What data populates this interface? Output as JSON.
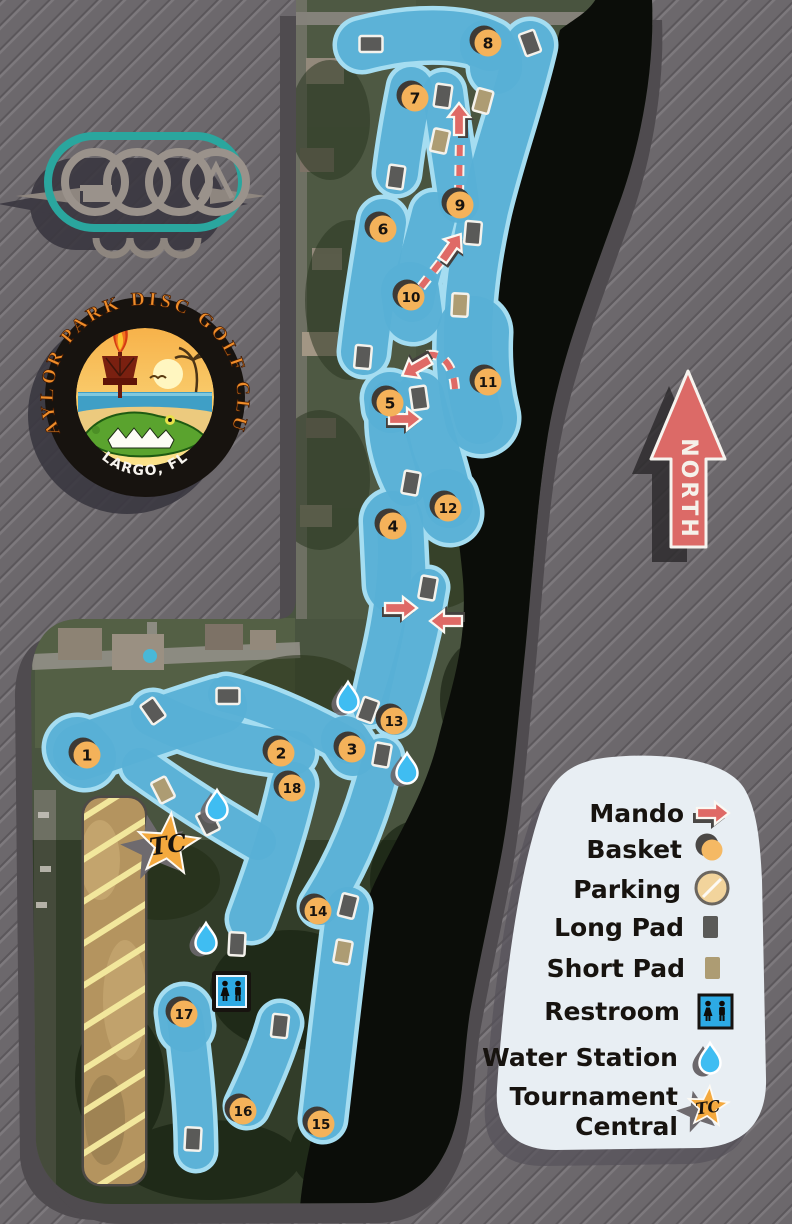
{
  "title": "Taylor Park Disc Golf Club Course Map",
  "colors": {
    "background": "#6c686c",
    "fairway": "#58b0d5",
    "fairway_border": "#a5ddf1",
    "mando_red": "#df6a66",
    "basket_orange": "#f4b25a",
    "parking_tan": "#f2d49c",
    "long_pad": "#5a5a58",
    "short_pad": "#ad9c73",
    "water_blue": "#3fbdf2",
    "legend_bg": "#e8eef3",
    "logo_teal": "#2aa69e",
    "lake": "#0b0d09"
  },
  "north_label": "NORTH",
  "club_logo": {
    "arc_text": "TAYLOR PARK DISC GOLF CLUB",
    "bottom_text": "LARGO, FL"
  },
  "legend": {
    "items": [
      {
        "label": "Mando",
        "icon": "mando-arrow"
      },
      {
        "label": "Basket",
        "icon": "basket-circle"
      },
      {
        "label": "Parking",
        "icon": "parking-circle"
      },
      {
        "label": "Long Pad",
        "icon": "long-pad-rect"
      },
      {
        "label": "Short Pad",
        "icon": "short-pad-rect"
      },
      {
        "label": "Restroom",
        "icon": "restroom-sign"
      },
      {
        "label": "Water Station",
        "icon": "water-drop"
      },
      {
        "line1": "Tournament",
        "line2": "Central",
        "icon": "tc-star"
      }
    ],
    "tc_icon_label": "TC"
  },
  "map": {
    "holes": [
      {
        "n": 1,
        "x": 87,
        "y": 755
      },
      {
        "n": 2,
        "x": 281,
        "y": 753
      },
      {
        "n": 3,
        "x": 352,
        "y": 749
      },
      {
        "n": 4,
        "x": 393,
        "y": 526
      },
      {
        "n": 5,
        "x": 390,
        "y": 403
      },
      {
        "n": 6,
        "x": 383,
        "y": 229
      },
      {
        "n": 7,
        "x": 415,
        "y": 98
      },
      {
        "n": 8,
        "x": 488,
        "y": 43
      },
      {
        "n": 9,
        "x": 460,
        "y": 205
      },
      {
        "n": 10,
        "x": 411,
        "y": 297
      },
      {
        "n": 11,
        "x": 488,
        "y": 382
      },
      {
        "n": 12,
        "x": 448,
        "y": 508
      },
      {
        "n": 13,
        "x": 394,
        "y": 721
      },
      {
        "n": 14,
        "x": 318,
        "y": 911
      },
      {
        "n": 15,
        "x": 321,
        "y": 1124
      },
      {
        "n": 16,
        "x": 243,
        "y": 1111
      },
      {
        "n": 17,
        "x": 184,
        "y": 1014
      },
      {
        "n": 18,
        "x": 292,
        "y": 788
      }
    ],
    "tee_pads": [
      {
        "type": "long",
        "x": 371,
        "y": 44,
        "rot": 90
      },
      {
        "type": "long",
        "x": 530,
        "y": 43,
        "rot": -20
      },
      {
        "type": "long",
        "x": 443,
        "y": 96,
        "rot": 8
      },
      {
        "type": "short",
        "x": 483,
        "y": 101,
        "rot": 15
      },
      {
        "type": "short",
        "x": 440,
        "y": 141,
        "rot": 12
      },
      {
        "type": "long",
        "x": 396,
        "y": 177,
        "rot": 8
      },
      {
        "type": "long",
        "x": 473,
        "y": 233,
        "rot": 5
      },
      {
        "type": "short",
        "x": 460,
        "y": 305,
        "rot": 3
      },
      {
        "type": "long",
        "x": 363,
        "y": 357,
        "rot": 5
      },
      {
        "type": "long",
        "x": 419,
        "y": 398,
        "rot": -8
      },
      {
        "type": "long",
        "x": 411,
        "y": 483,
        "rot": 10
      },
      {
        "type": "long",
        "x": 428,
        "y": 588,
        "rot": 10
      },
      {
        "type": "long",
        "x": 368,
        "y": 710,
        "rot": 20
      },
      {
        "type": "long",
        "x": 382,
        "y": 755,
        "rot": 10
      },
      {
        "type": "long",
        "x": 153,
        "y": 711,
        "rot": -35
      },
      {
        "type": "long",
        "x": 228,
        "y": 696,
        "rot": 90
      },
      {
        "type": "short",
        "x": 163,
        "y": 790,
        "rot": -27
      },
      {
        "type": "long",
        "x": 208,
        "y": 822,
        "rot": -27
      },
      {
        "type": "long",
        "x": 348,
        "y": 906,
        "rot": 14
      },
      {
        "type": "short",
        "x": 343,
        "y": 952,
        "rot": 10
      },
      {
        "type": "long",
        "x": 237,
        "y": 944,
        "rot": 3
      },
      {
        "type": "long",
        "x": 280,
        "y": 1026,
        "rot": 6
      },
      {
        "type": "long",
        "x": 193,
        "y": 1139,
        "rot": 3
      }
    ],
    "water_stations": [
      {
        "x": 348,
        "y": 697
      },
      {
        "x": 407,
        "y": 768
      },
      {
        "x": 217,
        "y": 805
      },
      {
        "x": 206,
        "y": 938
      }
    ],
    "mando_arrows": [
      {
        "x": 404,
        "y": 419,
        "dir": 0
      },
      {
        "x": 400,
        "y": 608,
        "dir": 0
      },
      {
        "x": 447,
        "y": 621,
        "dir": 180
      },
      {
        "x": 459,
        "y": 120,
        "dir": -90
      },
      {
        "x": 451,
        "y": 248,
        "dir": -55
      },
      {
        "x": 417,
        "y": 367,
        "dir": 150
      }
    ],
    "restroom": {
      "x": 231,
      "y": 991
    },
    "tournament_central": {
      "x": 168,
      "y": 845,
      "label": "TC"
    }
  }
}
